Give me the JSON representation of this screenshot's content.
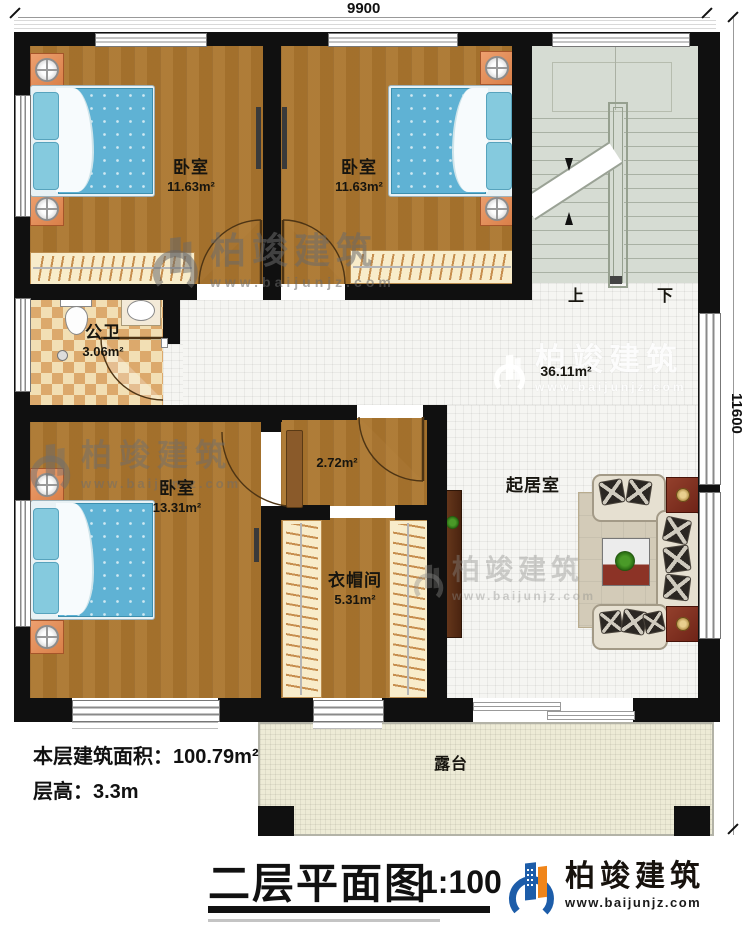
{
  "plan": {
    "dimensions": {
      "top": "9900",
      "right": "11600"
    },
    "rooms": [
      {
        "id": "bedroom-1",
        "label": "卧室",
        "area": "11.63m²"
      },
      {
        "id": "bedroom-2",
        "label": "卧室",
        "area": "11.63m²"
      },
      {
        "id": "bathroom",
        "label": "公卫",
        "area": "3.06m²"
      },
      {
        "id": "bedroom-3",
        "label": "卧室",
        "area": "13.31m²"
      },
      {
        "id": "hall",
        "area": "2.72m²"
      },
      {
        "id": "cloakroom",
        "label": "衣帽间",
        "area": "5.31m²"
      },
      {
        "id": "living-room",
        "label": "起居室",
        "area": "36.11m²"
      },
      {
        "id": "terrace",
        "label": "露台"
      }
    ],
    "stairs": {
      "up": "上",
      "down": "下"
    }
  },
  "notes": {
    "floor_area_label": "本层建筑面积：",
    "floor_area_value": "100.79m²",
    "floor_height_label": "层高：",
    "floor_height_value": "3.3m"
  },
  "title_block": {
    "title": "二层平面图",
    "scale": "1:100"
  },
  "brand": {
    "name": "柏竣建筑",
    "url": "www.baijunjz.com"
  },
  "watermark": {
    "name": "柏竣建筑",
    "url": "www.baijunjz.com"
  },
  "colors": {
    "wall": "#101010",
    "wood": "#a9752f",
    "tile": "#f5f5f2",
    "stairs": "#d6dcd3",
    "bathroom_tile": "#dca96c",
    "terrace": "#edebd6",
    "bed": "#5fb2d4",
    "brand_blue": "#1d5da9",
    "brand_orange": "#f08519"
  }
}
